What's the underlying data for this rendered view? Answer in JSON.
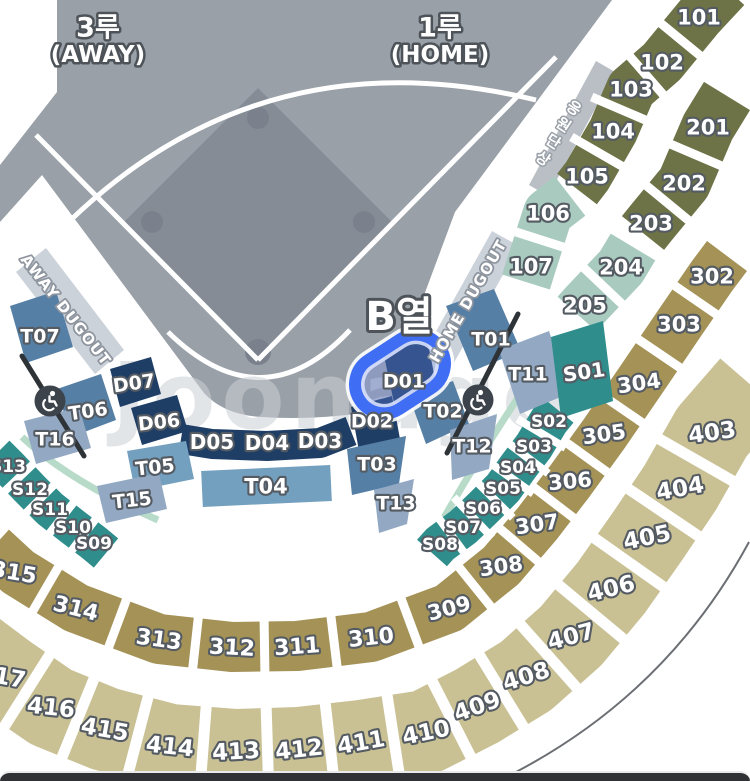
{
  "palette": {
    "olive": "#6d7347",
    "sage": "#a8cabf",
    "dkkhaki": "#a49257",
    "ltkhaki": "#c9c094",
    "blue": "#567fa5",
    "lightblue": "#74a0bf",
    "grayblue": "#93a9c3",
    "navy": "#1f3e66",
    "teal": "#2f8e8b",
    "field": "#99a0a8",
    "infield": "#858c96",
    "basecircle": "#7a818c",
    "dugout_strip": "#ccd2da",
    "cheer_strip": "#b9bfc5",
    "stair": "#2e3338",
    "mint": "#b7dbc8",
    "highlight": "#3f6ef4",
    "sliver": "#49a18f"
  },
  "bands": [
    {
      "n": "100-upper",
      "c": "olive",
      "w": 50,
      "gapw": 9,
      "path": [
        [
          726,
          -12
        ],
        [
          699,
          17
        ],
        [
          662,
          62
        ],
        [
          631,
          89
        ],
        [
          613,
          131
        ],
        [
          587,
          176
        ],
        [
          577,
          189
        ]
      ],
      "labels": [
        {
          "t": "101",
          "x": 699,
          "y": 17,
          "fs": 21
        },
        {
          "t": "102",
          "x": 662,
          "y": 62,
          "fs": 21
        },
        {
          "t": "103",
          "x": 631,
          "y": 89,
          "fs": 21
        },
        {
          "t": "104",
          "x": 613,
          "y": 131,
          "fs": 21
        },
        {
          "t": "105",
          "x": 587,
          "y": 176,
          "fs": 21
        }
      ]
    },
    {
      "n": "100-lower",
      "c": "sage",
      "w": 50,
      "gapw": 9,
      "path": [
        [
          570,
          196
        ],
        [
          548,
          213
        ],
        [
          531,
          266
        ],
        [
          526,
          282
        ]
      ],
      "labels": [
        {
          "t": "106",
          "x": 548,
          "y": 213,
          "fs": 21
        },
        {
          "t": "107",
          "x": 531,
          "y": 266,
          "fs": 21
        }
      ]
    },
    {
      "n": "200-upper",
      "c": "olive",
      "w": 54,
      "gapw": 9,
      "path": [
        [
          727,
          96
        ],
        [
          708,
          127
        ],
        [
          684,
          183
        ],
        [
          651,
          223
        ],
        [
          643,
          233
        ]
      ],
      "labels": [
        {
          "t": "201",
          "x": 708,
          "y": 127,
          "fs": 21
        },
        {
          "t": "202",
          "x": 684,
          "y": 183,
          "fs": 21
        },
        {
          "t": "203",
          "x": 651,
          "y": 223,
          "fs": 21
        }
      ]
    },
    {
      "n": "200-lower",
      "c": "sage",
      "w": 52,
      "gapw": 9,
      "path": [
        [
          633,
          247
        ],
        [
          621,
          267
        ],
        [
          585,
          305
        ],
        [
          577,
          314
        ]
      ],
      "labels": [
        {
          "t": "204",
          "x": 621,
          "y": 267,
          "fs": 21
        },
        {
          "t": "205",
          "x": 585,
          "y": 305,
          "fs": 21
        }
      ]
    },
    {
      "n": "300",
      "c": "dkkhaki",
      "w": 50,
      "gapw": 9,
      "path": [
        [
          727,
          256
        ],
        [
          712,
          276
        ],
        [
          679,
          324
        ],
        [
          639,
          383
        ],
        [
          604,
          434
        ],
        [
          570,
          481
        ],
        [
          537,
          524
        ],
        [
          501,
          566
        ],
        [
          449,
          608
        ],
        [
          371,
          637
        ],
        [
          297,
          646
        ],
        [
          232,
          647
        ],
        [
          159,
          639
        ],
        [
          76,
          608
        ],
        [
          18,
          572
        ],
        [
          -8,
          548
        ]
      ],
      "labels": [
        {
          "t": "302",
          "x": 712,
          "y": 276,
          "fs": 21
        },
        {
          "t": "303",
          "x": 679,
          "y": 324,
          "fs": 21
        },
        {
          "t": "304",
          "x": 639,
          "y": 383,
          "fs": 21,
          "rot": -8
        },
        {
          "t": "305",
          "x": 604,
          "y": 434,
          "fs": 21,
          "rot": -8
        },
        {
          "t": "306",
          "x": 570,
          "y": 481,
          "fs": 21,
          "rot": -5
        },
        {
          "t": "307",
          "x": 537,
          "y": 524,
          "fs": 21,
          "rot": -8
        },
        {
          "t": "308",
          "x": 501,
          "y": 566,
          "fs": 21,
          "rot": -8
        },
        {
          "t": "309",
          "x": 449,
          "y": 608,
          "fs": 21,
          "rot": -15
        },
        {
          "t": "310",
          "x": 371,
          "y": 637,
          "fs": 22,
          "rot": -6
        },
        {
          "t": "311",
          "x": 297,
          "y": 646,
          "fs": 22,
          "rot": -4
        },
        {
          "t": "312",
          "x": 232,
          "y": 647,
          "fs": 22,
          "rot": 3
        },
        {
          "t": "313",
          "x": 159,
          "y": 639,
          "fs": 22,
          "rot": 8
        },
        {
          "t": "314",
          "x": 76,
          "y": 608,
          "fs": 22,
          "rot": 14
        },
        {
          "t": "315",
          "x": 14,
          "y": 572,
          "fs": 22,
          "rot": 10
        }
      ]
    },
    {
      "n": "400",
      "c": "ltkhaki",
      "w": 84,
      "gapw": 11,
      "path": [
        [
          752,
          386
        ],
        [
          712,
          432
        ],
        [
          680,
          488
        ],
        [
          647,
          537
        ],
        [
          611,
          588
        ],
        [
          571,
          636
        ],
        [
          526,
          676
        ],
        [
          477,
          706
        ],
        [
          426,
          732
        ],
        [
          361,
          742
        ],
        [
          299,
          749
        ],
        [
          236,
          751
        ],
        [
          170,
          746
        ],
        [
          105,
          729
        ],
        [
          51,
          707
        ],
        [
          6,
          676
        ],
        [
          -26,
          652
        ]
      ],
      "labels": [
        {
          "t": "403",
          "x": 712,
          "y": 432,
          "fs": 23,
          "rot": -8
        },
        {
          "t": "404",
          "x": 680,
          "y": 488,
          "fs": 23,
          "rot": -10
        },
        {
          "t": "405",
          "x": 647,
          "y": 537,
          "fs": 23,
          "rot": -12
        },
        {
          "t": "406",
          "x": 611,
          "y": 588,
          "fs": 23,
          "rot": -14
        },
        {
          "t": "407",
          "x": 571,
          "y": 636,
          "fs": 23,
          "rot": -15
        },
        {
          "t": "408",
          "x": 526,
          "y": 676,
          "fs": 23,
          "rot": -18
        },
        {
          "t": "409",
          "x": 477,
          "y": 706,
          "fs": 23,
          "rot": -20
        },
        {
          "t": "410",
          "x": 426,
          "y": 732,
          "fs": 23,
          "rot": -12
        },
        {
          "t": "411",
          "x": 361,
          "y": 742,
          "fs": 23,
          "rot": -10
        },
        {
          "t": "412",
          "x": 299,
          "y": 749,
          "fs": 23,
          "rot": -6
        },
        {
          "t": "413",
          "x": 236,
          "y": 751,
          "fs": 23,
          "rot": -3
        },
        {
          "t": "414",
          "x": 170,
          "y": 746,
          "fs": 23,
          "rot": 6
        },
        {
          "t": "415",
          "x": 105,
          "y": 729,
          "fs": 23,
          "rot": 10
        },
        {
          "t": "416",
          "x": 51,
          "y": 707,
          "fs": 23,
          "rot": 6
        },
        {
          "t": "417",
          "x": 2,
          "y": 676,
          "fs": 23,
          "rot": 10
        }
      ]
    },
    {
      "n": "S-right",
      "c": "teal",
      "w": 40,
      "gapw": 8,
      "path": [
        [
          558,
          410
        ],
        [
          549,
          421
        ],
        [
          534,
          446
        ],
        [
          518,
          467
        ],
        [
          503,
          488
        ],
        [
          483,
          508
        ],
        [
          463,
          527
        ],
        [
          440,
          544
        ],
        [
          432,
          553
        ]
      ],
      "labels": [
        {
          "t": "S02",
          "x": 549,
          "y": 421,
          "fs": 17
        },
        {
          "t": "S03",
          "x": 534,
          "y": 446,
          "fs": 17
        },
        {
          "t": "S04",
          "x": 518,
          "y": 467,
          "fs": 17
        },
        {
          "t": "S05",
          "x": 503,
          "y": 488,
          "fs": 17
        },
        {
          "t": "S06",
          "x": 483,
          "y": 508,
          "fs": 17
        },
        {
          "t": "S07",
          "x": 463,
          "y": 527,
          "fs": 17
        },
        {
          "t": "S08",
          "x": 440,
          "y": 544,
          "fs": 17
        }
      ]
    },
    {
      "n": "S-left",
      "c": "teal",
      "w": 38,
      "gapw": 8,
      "path": [
        [
          106,
          553
        ],
        [
          94,
          543
        ],
        [
          73,
          527
        ],
        [
          50,
          509
        ],
        [
          30,
          489
        ],
        [
          8,
          466
        ],
        [
          -4,
          454
        ]
      ],
      "labels": [
        {
          "t": "S09",
          "x": 94,
          "y": 543,
          "fs": 17
        },
        {
          "t": "S10",
          "x": 73,
          "y": 527,
          "fs": 17
        },
        {
          "t": "S11",
          "x": 50,
          "y": 509,
          "fs": 17
        },
        {
          "t": "S12",
          "x": 30,
          "y": 489,
          "fs": 17
        },
        {
          "t": "S13",
          "x": 8,
          "y": 466,
          "fs": 17
        }
      ]
    },
    {
      "n": "D-mid",
      "c": "navy",
      "w": 30,
      "gaps": false,
      "path": [
        [
          181,
          439
        ],
        [
          212,
          444
        ],
        [
          267,
          446
        ],
        [
          320,
          443
        ],
        [
          351,
          431
        ]
      ],
      "labels": [
        {
          "t": "D05",
          "x": 212,
          "y": 442,
          "fs": 20
        },
        {
          "t": "D04",
          "x": 267,
          "y": 443,
          "fs": 20
        },
        {
          "t": "D03",
          "x": 320,
          "y": 441,
          "fs": 20
        }
      ]
    },
    {
      "n": "T04",
      "c": "lightblue",
      "w": 36,
      "gaps": false,
      "path": [
        [
          202,
          489
        ],
        [
          266,
          486
        ],
        [
          331,
          483
        ]
      ],
      "labels": [
        {
          "t": "T04",
          "x": 266,
          "y": 486,
          "fs": 21
        }
      ]
    }
  ],
  "sections": [
    {
      "n": "T07",
      "c": "blue",
      "pts": [
        [
          10,
          306
        ],
        [
          56,
          291
        ],
        [
          73,
          347
        ],
        [
          26,
          363
        ]
      ],
      "l": {
        "t": "T07",
        "x": 40,
        "y": 336,
        "fs": 19
      }
    },
    {
      "n": "T06",
      "c": "blue",
      "pts": [
        [
          57,
          389
        ],
        [
          101,
          374
        ],
        [
          116,
          420
        ],
        [
          71,
          437
        ]
      ],
      "l": {
        "t": "T06",
        "x": 88,
        "y": 411,
        "fs": 19,
        "rot": -8
      }
    },
    {
      "n": "T16",
      "c": "grayblue",
      "pts": [
        [
          24,
          421
        ],
        [
          79,
          407
        ],
        [
          91,
          448
        ],
        [
          36,
          464
        ]
      ],
      "l": {
        "t": "T16",
        "x": 55,
        "y": 439,
        "fs": 19
      }
    },
    {
      "n": "T05",
      "c": "lightblue",
      "pts": [
        [
          127,
          451
        ],
        [
          186,
          441
        ],
        [
          194,
          479
        ],
        [
          135,
          491
        ]
      ],
      "l": {
        "t": "T05",
        "x": 155,
        "y": 467,
        "fs": 19,
        "rot": -6
      }
    },
    {
      "n": "T15",
      "c": "grayblue",
      "pts": [
        [
          97,
          486
        ],
        [
          159,
          473
        ],
        [
          167,
          509
        ],
        [
          106,
          523
        ]
      ],
      "l": {
        "t": "T15",
        "x": 132,
        "y": 500,
        "fs": 19,
        "rot": -6
      }
    },
    {
      "n": "D07",
      "c": "navy",
      "pts": [
        [
          110,
          369
        ],
        [
          151,
          357
        ],
        [
          161,
          394
        ],
        [
          120,
          407
        ]
      ],
      "l": {
        "t": "D07",
        "x": 134,
        "y": 383,
        "fs": 19,
        "rot": -8
      }
    },
    {
      "n": "D06",
      "c": "navy",
      "pts": [
        [
          131,
          408
        ],
        [
          177,
          395
        ],
        [
          188,
          431
        ],
        [
          142,
          445
        ]
      ],
      "l": {
        "t": "D06",
        "x": 159,
        "y": 422,
        "fs": 19,
        "rot": -6
      }
    },
    {
      "n": "D01",
      "c": "navy",
      "pts": [
        [
          382,
          346
        ],
        [
          426,
          333
        ],
        [
          437,
          389
        ],
        [
          394,
          403
        ]
      ],
      "l": {
        "t": "D01",
        "x": 404,
        "y": 381,
        "fs": 19
      }
    },
    {
      "n": "D02",
      "c": "navy",
      "pts": [
        [
          351,
          407
        ],
        [
          392,
          396
        ],
        [
          400,
          439
        ],
        [
          359,
          451
        ]
      ],
      "l": {
        "t": "D02",
        "x": 372,
        "y": 421,
        "fs": 19
      }
    },
    {
      "n": "T02",
      "c": "blue",
      "pts": [
        [
          409,
          396
        ],
        [
          453,
          381
        ],
        [
          469,
          424
        ],
        [
          426,
          444
        ]
      ],
      "l": {
        "t": "T02",
        "x": 443,
        "y": 411,
        "fs": 19
      }
    },
    {
      "n": "T12",
      "c": "grayblue",
      "pts": [
        [
          450,
          430
        ],
        [
          497,
          414
        ],
        [
          489,
          469
        ],
        [
          452,
          480
        ]
      ],
      "l": {
        "t": "T12",
        "x": 472,
        "y": 446,
        "fs": 19
      }
    },
    {
      "n": "T03",
      "c": "blue",
      "pts": [
        [
          347,
          449
        ],
        [
          406,
          436
        ],
        [
          399,
          484
        ],
        [
          352,
          495
        ]
      ],
      "l": {
        "t": "T03",
        "x": 377,
        "y": 464,
        "fs": 19
      }
    },
    {
      "n": "T13",
      "c": "grayblue",
      "pts": [
        [
          374,
          490
        ],
        [
          414,
          479
        ],
        [
          407,
          524
        ],
        [
          379,
          533
        ]
      ],
      "l": {
        "t": "T13",
        "x": 396,
        "y": 503,
        "fs": 19
      }
    },
    {
      "n": "T01",
      "c": "blue",
      "pts": [
        [
          446,
          306
        ],
        [
          494,
          289
        ],
        [
          521,
          351
        ],
        [
          473,
          371
        ]
      ],
      "l": {
        "t": "T01",
        "x": 491,
        "y": 339,
        "fs": 19
      }
    },
    {
      "n": "T11",
      "c": "grayblue",
      "pts": [
        [
          499,
          350
        ],
        [
          549,
          331
        ],
        [
          570,
          393
        ],
        [
          520,
          414
        ]
      ],
      "l": {
        "t": "T11",
        "x": 528,
        "y": 374,
        "fs": 19
      }
    },
    {
      "n": "S01",
      "c": "teal",
      "pts": [
        [
          551,
          337
        ],
        [
          603,
          321
        ],
        [
          613,
          401
        ],
        [
          561,
          418
        ]
      ],
      "l": {
        "t": "S01",
        "x": 584,
        "y": 372,
        "fs": 20,
        "rot": -8
      }
    }
  ],
  "texts": [
    {
      "n": "label-3b-away-line1",
      "t": "3루",
      "x": 98,
      "y": 27,
      "fs": 27,
      "cls": "title"
    },
    {
      "n": "label-3b-away-line2",
      "t": "(AWAY)",
      "x": 98,
      "y": 54,
      "fs": 23,
      "cls": "title"
    },
    {
      "n": "label-1b-home-line1",
      "t": "1루",
      "x": 440,
      "y": 27,
      "fs": 27,
      "cls": "title"
    },
    {
      "n": "label-1b-home-line2",
      "t": "(HOME)",
      "x": 440,
      "y": 54,
      "fs": 23,
      "cls": "title"
    },
    {
      "n": "selected-row-label",
      "t": "B열",
      "x": 399,
      "y": 316,
      "fs": 40,
      "cls": "title big"
    },
    {
      "n": "home-dugout-label",
      "t": "HOME DUGOUT",
      "x": 468,
      "y": 301,
      "fs": 15,
      "rot": -60,
      "cls": "dug"
    },
    {
      "n": "away-dugout-label",
      "t": "AWAY DUGOUT",
      "x": 66,
      "y": 310,
      "fs": 15,
      "rot": 52,
      "cls": "dug"
    },
    {
      "n": "watermark",
      "t": "Joonago",
      "x": 112,
      "y": 428,
      "fs": 92,
      "cls": "wm"
    }
  ],
  "vertical_texts": [
    {
      "n": "cheering-stand-label",
      "t": "응원단상",
      "x": 574,
      "y": 108,
      "dx": -10.3,
      "dy": 16.8,
      "rot": 33,
      "fs": 15,
      "cls": "vst"
    }
  ],
  "icons": {
    "wheelchair": [
      {
        "x": 50,
        "y": 401
      },
      {
        "x": 478,
        "y": 400
      }
    ]
  }
}
